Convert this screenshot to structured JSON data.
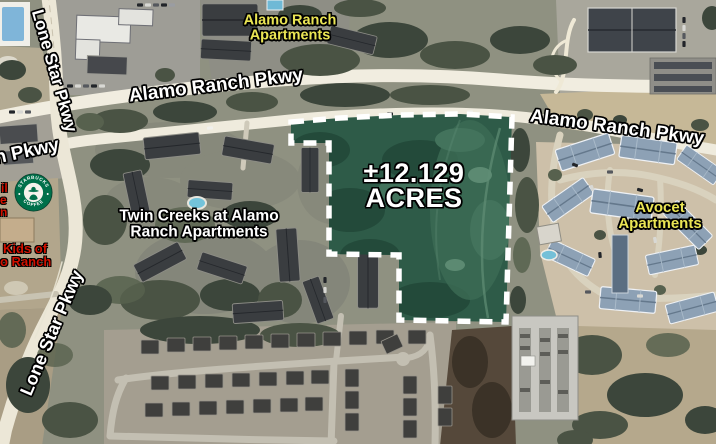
{
  "map": {
    "acreage": {
      "line1": "±12.129",
      "line2": "ACRES"
    },
    "roads": {
      "lone_star_top": "Lone Star Pkwy",
      "alamo_ranch_west": "Alamo Ranch Pkwy",
      "n_pkwy_partial": "n Pkwy",
      "alamo_ranch_east": "Alamo Ranch Pkwy",
      "lone_star_bottom": "Lone Star Pkwy"
    },
    "places": {
      "alamo_ranch_apartments": {
        "line1": "Alamo Ranch",
        "line2": "Apartments"
      },
      "twin_creeks": {
        "line1": "Twin Creeks at Alamo",
        "line2": "Ranch Apartments"
      },
      "avocet": {
        "line1": "Avocet",
        "line2": "Apartments"
      },
      "partial_red": {
        "f1": "il",
        "f2": "e",
        "f3": "n",
        "line1": "Kids of",
        "line2": "o Ranch"
      }
    },
    "starbucks": {
      "top": "STARBUCKS",
      "bottom": "COFFEE"
    },
    "colors": {
      "parcel_fill": "#2e5b48",
      "parcel_border": "#ffffff",
      "road_label": "#ffffff",
      "apartment_label": "#eae554",
      "partial_label_red": "#d21000",
      "starbucks_green": "#00704a"
    }
  }
}
